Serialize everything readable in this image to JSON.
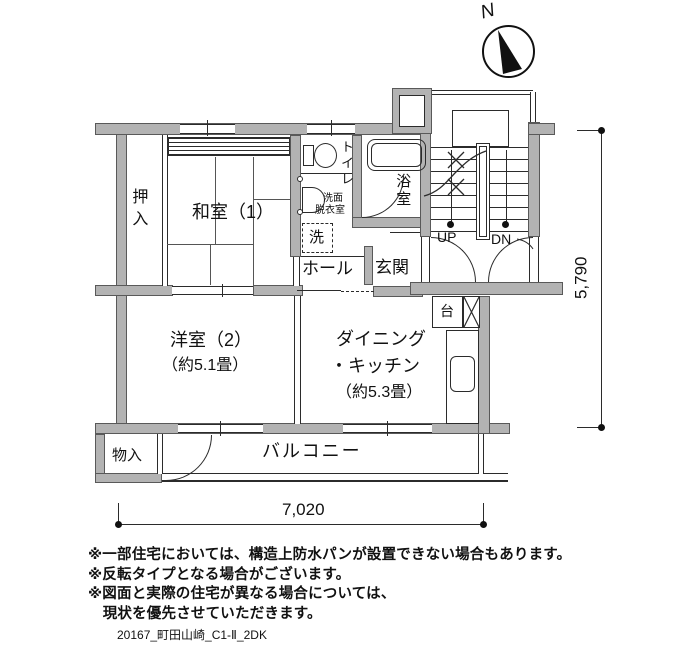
{
  "compass": {
    "label": "N"
  },
  "dim": {
    "horizontal": "7,020",
    "vertical": "5,790"
  },
  "rooms": {
    "oshiire": "押入",
    "washitsu": "和室（1）",
    "toilet": "トイレ",
    "senmen1": "洗面",
    "senmen2": "脱衣室",
    "laundry": "洗",
    "bath": "浴室",
    "hall": "ホール",
    "genkan": "玄関",
    "up": "UP",
    "dn": "DN",
    "dai": "台",
    "yoshitsu1": "洋室（2）",
    "yoshitsu2": "（約5.1畳）",
    "dk1": "ダイニング",
    "dk2": "・キッチン",
    "dk3": "（約5.3畳）",
    "monoire": "物入",
    "balcony": "バルコニー"
  },
  "notes": {
    "line1": "※一部住宅においては、構造上防水パンが設置できない場合もあります。",
    "line2": "※反転タイプとなる場合がございます。",
    "line3": "※図面と実際の住宅が異なる場合については、",
    "line4": "　現状を優先させていただきます。"
  },
  "footer": "20167_町田山崎_C1-Ⅱ_2DK",
  "colors": {
    "wall_fill": "#b3b3b3",
    "line": "#2b2b2b"
  }
}
